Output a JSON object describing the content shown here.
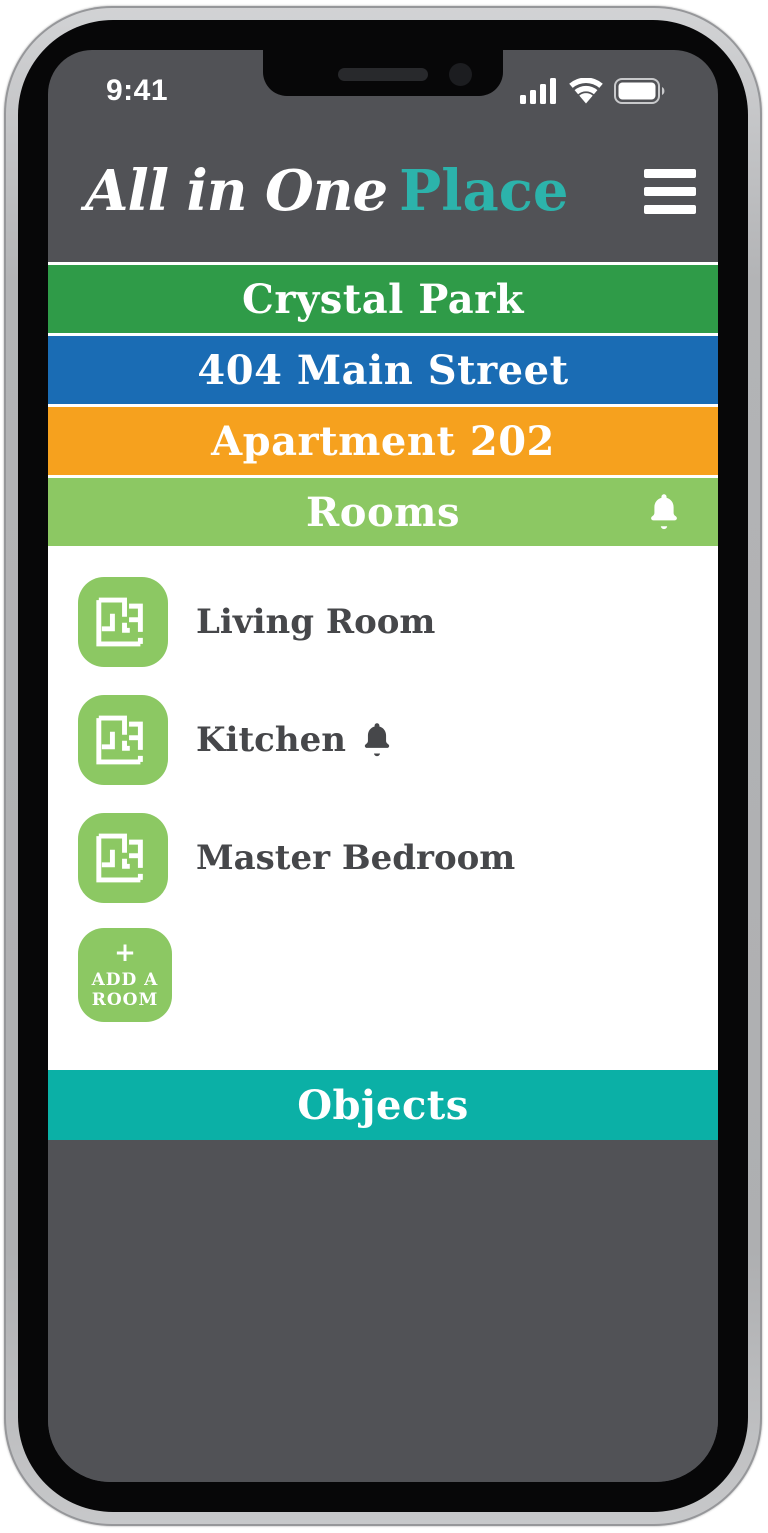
{
  "app": {
    "name_script": "All in One",
    "name_accent": "Place"
  },
  "status_bar": {
    "time": "9:41",
    "signal_icon": "signal-bars",
    "wifi_icon": "wifi",
    "battery_icon": "battery-full"
  },
  "header": {
    "menu_icon": "hamburger-menu"
  },
  "nav": {
    "items": [
      {
        "label": "Crystal Park",
        "color": "#2f9b48"
      },
      {
        "label": "404 Main Street",
        "color": "#1a6cb4"
      },
      {
        "label": "Apartment 202",
        "color": "#f6a11e"
      },
      {
        "label": "Rooms",
        "color": "#8cc863",
        "bell_icon": "bell"
      }
    ]
  },
  "rooms": {
    "items": [
      {
        "label": "Living Room",
        "has_alert": false,
        "icon": "floor-plan"
      },
      {
        "label": "Kitchen",
        "has_alert": true,
        "icon": "floor-plan",
        "alert_icon": "bell"
      },
      {
        "label": "Master Bedroom",
        "has_alert": false,
        "icon": "floor-plan"
      }
    ],
    "add_button": {
      "plus": "+",
      "line1": "ADD A",
      "line2": "ROOM"
    }
  },
  "objects": {
    "label": "Objects",
    "color": "#0bb0a6"
  },
  "colors": {
    "accent_teal": "#2cb3ab",
    "green": "#2f9b48",
    "blue": "#1a6cb4",
    "orange": "#f6a11e",
    "light_green": "#8cc863",
    "teal": "#0bb0a6",
    "screen_gray": "#515256",
    "text_dark": "#46474a"
  }
}
